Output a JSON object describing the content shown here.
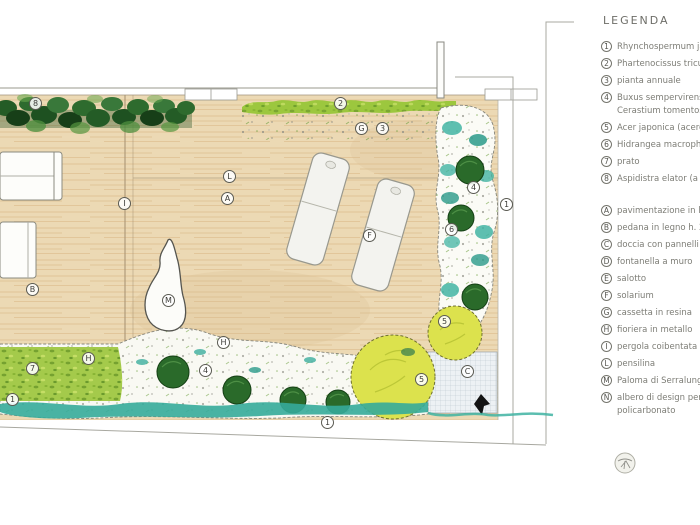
{
  "legend": {
    "title": "LEGENDA",
    "plants": [
      {
        "num": "1",
        "text": "Rhynchospermum jas"
      },
      {
        "num": "2",
        "text": "Phartenocissus tricus"
      },
      {
        "num": "3",
        "text": "pianta annuale"
      },
      {
        "num": "4",
        "text": "Buxus sempervirens (",
        "text2": "Cerastium tomentos"
      },
      {
        "num": "5",
        "text": "Acer japonica (acero"
      },
      {
        "num": "6",
        "text": "Hidrangea macrophil"
      },
      {
        "num": "7",
        "text": "prato"
      },
      {
        "num": "8",
        "text": "Aspidistra elator (a"
      }
    ],
    "elements": [
      {
        "num": "A",
        "text": "pavimentazione in leg"
      },
      {
        "num": "B",
        "text": "pedana in legno h. 2"
      },
      {
        "num": "C",
        "text": "doccia con pannelli a"
      },
      {
        "num": "D",
        "text": "fontanella a muro"
      },
      {
        "num": "E",
        "text": "salotto"
      },
      {
        "num": "F",
        "text": "solarium"
      },
      {
        "num": "G",
        "text": "cassetta in resina"
      },
      {
        "num": "H",
        "text": "fioriera in metallo"
      },
      {
        "num": "I",
        "text": "pergola coibentata"
      },
      {
        "num": "L",
        "text": "pensilina"
      },
      {
        "num": "M",
        "text": "Paloma di Serralunga"
      },
      {
        "num": "N",
        "text": "albero di design per",
        "text2": "policarbonato"
      }
    ]
  },
  "plan": {
    "labels": [
      {
        "text": "8"
      },
      {
        "text": "2"
      },
      {
        "text": "G"
      },
      {
        "text": "3"
      },
      {
        "text": "L"
      },
      {
        "text": "A"
      },
      {
        "text": "I"
      },
      {
        "text": "F"
      },
      {
        "text": "4"
      },
      {
        "text": "1"
      },
      {
        "text": "6"
      },
      {
        "text": "B"
      },
      {
        "text": "M"
      },
      {
        "text": "7"
      },
      {
        "text": "H"
      },
      {
        "text": "1"
      },
      {
        "text": "H"
      },
      {
        "text": "4"
      },
      {
        "text": "1"
      },
      {
        "text": "5"
      },
      {
        "text": "5"
      },
      {
        "text": "C"
      }
    ]
  },
  "colors": {
    "deck": "#ecd9b4",
    "hedge_dark_green": "#2e6b2e",
    "leaf_green": "#9cc73e",
    "teal": "#3fb3a2",
    "acer_yellow": "#dce24d",
    "line_gray": "#a8a8a0"
  }
}
